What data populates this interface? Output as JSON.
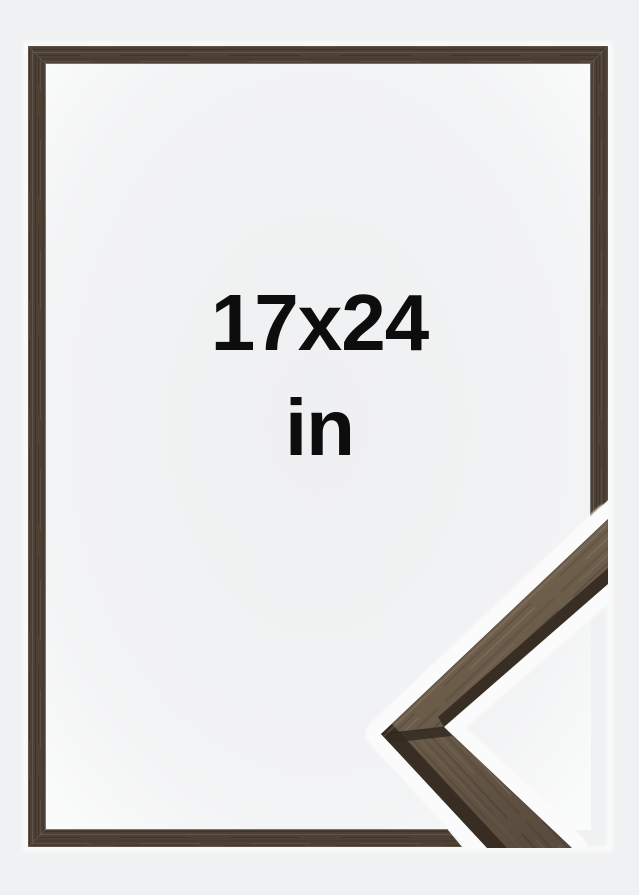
{
  "product_image": {
    "size_label": "17x24",
    "unit_label": "in",
    "description": "Wooden picture frame size mockup with corner profile sample"
  },
  "colors": {
    "background": "#f0f1f2",
    "interior_edge_glow": "#fafbfb",
    "frame_wood": "#4d4135",
    "frame_wood_highlight": "#7c6c58",
    "frame_wood_shadow": "#241d16",
    "corner_face": "#6a5b4a",
    "corner_face_light": "#74644f",
    "corner_face_dark": "#5a4c3e",
    "corner_edge": "#342a21",
    "corner_halo": "#fbfbfc",
    "label_text": "#0d0d0d"
  }
}
